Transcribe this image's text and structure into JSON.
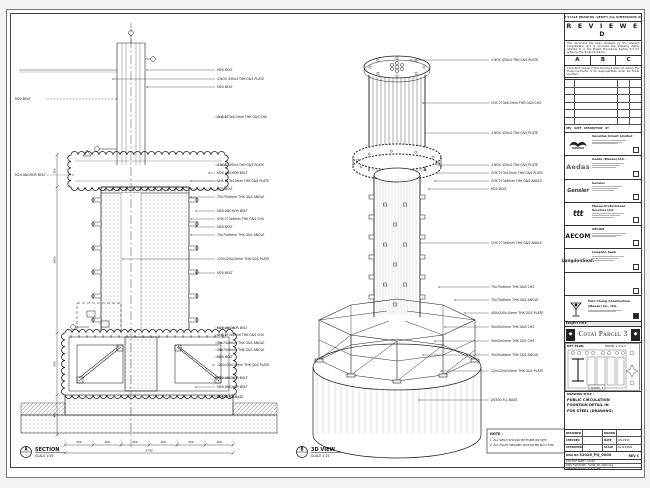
{
  "left_view": {
    "title": "SECTION",
    "scale": "SCALE 1:25",
    "bubble_top": "A",
    "bubble_bottom": "-",
    "labels_right": [
      "M20 BOLT",
      "4 NOS 450x4 THK G&S PLATE",
      "M20 BOLT",
      "CHS 273x6.3mm THK G&S CHS",
      "4 NOS 450x4 THK G&S PLATE",
      "M20 ANCHOR BOLT",
      "CHS 273x10mm THK G&S PLATE",
      "M20 BOLT",
      "75x75x6mm THK G&S ANGLE",
      "M20 ANCHOR BOLT",
      "CHS 273x6mm THK G&S CHS",
      "M20 BOLT",
      "75x75x6mm THK G&S ANGLE",
      "120x120x10mm THK G&S PLATE",
      "M20 BOLT",
      "M20 ANCHOR BOLT",
      "CHS 273x6mm THK G&S CHS",
      "75x75x6mm THK G&S ANGLE",
      "75x75x6mm THK G&S ANGLE",
      "M20 BOLT",
      "120x120x10mm THK G&S PLATE",
      "M20 ANCHOR BOLT",
      "M20 ANCHOR BOLT",
      "Ø2500 R.C BASE"
    ],
    "labels_left": [
      "M20 BOLT",
      "M24 ANCHOR BOLT"
    ],
    "dims": [
      "450",
      "450",
      "450",
      "450",
      "450",
      "450"
    ],
    "total": "2700",
    "vdims": [
      "300",
      "1450",
      "600",
      "400"
    ]
  },
  "iso_view": {
    "title": "3D VIEW",
    "scale": "SCALE 1:25",
    "bubble_top": "B",
    "bubble_bottom": "-",
    "labels": [
      "4 NOS 450x4 THK G&S PLATE",
      "CHS 273x6.3mm THK G&S CHS",
      "4 NOS 450x4 THK G&S PLATE",
      "4 NOS 450x4 THK G&S PLATE",
      "CHS 273x10mm THK G&S PLATE",
      "CHS 273x6mm THK G&S ANGLE",
      "M20 BOLT",
      "CHS 273x6mm THK G&S ANGLE",
      "75x75x6mm THK G&S CHS",
      "75x75x6mm THK G&S ANGLE",
      "400x200x10mm THK G&S PLATE",
      "50x50x5mm THK G&S CHS",
      "50x50x5mm THK G&S CHS",
      "50x50x6mm THK G&S ANGLE",
      "120x120x10mm THK G&S PLATE",
      "Ø2500 R.C BASE"
    ],
    "note_title": "NOTE :",
    "note_lines": [
      "1. ALL WELD SHOULD BE FORM ON SITE.",
      "2. ALL FILLET WELDED SHOULD BE 6mm THK."
    ]
  },
  "titleblock": {
    "strip": "DO NOT SCALE DRAWING. VERIFY ALL DIMENSIONS ON SITE.",
    "reviewed": {
      "title": "R E V I E W E D",
      "para1": "This document has been reviewed by the relevant Consultant(s) and is accorded the following status referred  to in the Project Procedures Section 5.4 for action by the Trade Contractor.",
      "options": [
        "A",
        "B",
        "C"
      ],
      "para2": "Consultant review of this document does not relieve the Trade Contractor of its responsibilities under the Trade Contract.",
      "date_label": "Date :"
    },
    "approval_footer": [
      "REV",
      "DATE",
      "DESCRIPTION",
      "BY"
    ],
    "companies": [
      {
        "name": "Venetian Orient Limited"
      },
      {
        "logo": "Aedas",
        "name": "Aedas (Macau) Ltd."
      },
      {
        "logo": "Gensler",
        "name": "Gensler"
      },
      {
        "logo": "ttt",
        "name": "Macau Professional Services Ltd."
      },
      {
        "logo": "AECOM",
        "name": "AECOM"
      },
      {
        "logo": "LangdonSeah",
        "name": "Langdon Seah"
      },
      {
        "name": ""
      }
    ],
    "contractor": {
      "line1": "Hsin Chong Construction",
      "line2": "(Macau) Co., Ltd."
    },
    "project": {
      "label": "PROJECT TITLE",
      "name": "Cotai Parcel 3"
    },
    "key_plan": {
      "label": "KEY PLAN",
      "right_label": "PARCEL 1, 2 & 3",
      "tag": "PARCEL 3"
    },
    "drawing_title": {
      "label": "DRAWING TITLE :",
      "lines": [
        "PUBLIC CIRCULATION",
        "FOUNTAIN DETAIL IN",
        "FOR STEEL (DRAWING)"
      ]
    },
    "info": {
      "rows": [
        {
          "l1": "DESIGNED",
          "v1": "-",
          "l2": "DRAWN",
          "v2": "-"
        },
        {
          "l1": "CHECKED",
          "v1": "-",
          "l2": "DATE",
          "v2": "JAN 2015"
        },
        {
          "l1": "APPROVED",
          "v1": "-",
          "l2": "SCALE",
          "v2": "AS SHOWN"
        }
      ],
      "dwg_label": "DWG NO",
      "dwg_no": "51026_PQ_0000",
      "rev": "REV C",
      "cad_label": "CAD FILE NAME :",
      "cad_value": "51026",
      "file_label": "DWG FILE NAME :",
      "file_value": "51026_PQ_0000.dwg",
      "ref_label": "REFERENCE DWG FILE NAME"
    }
  }
}
